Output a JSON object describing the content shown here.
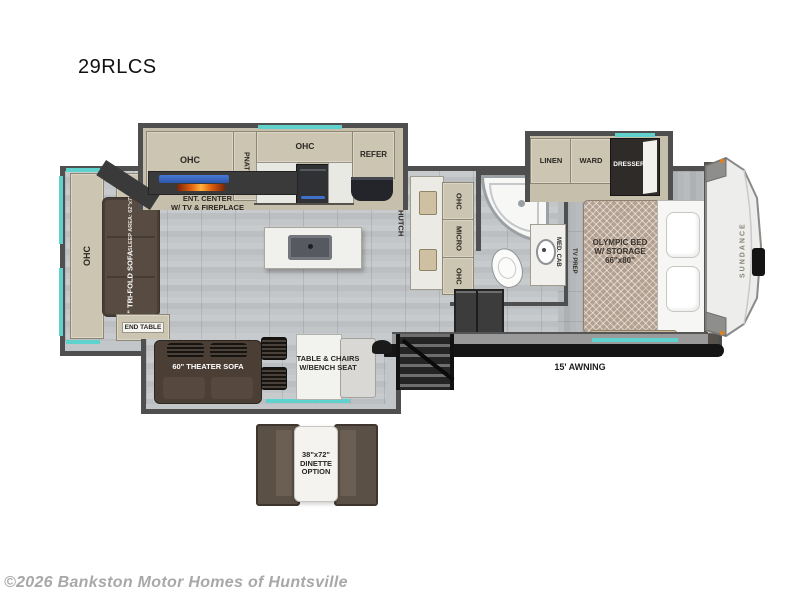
{
  "title": "29RLCS",
  "brand": "SUNDANCE",
  "footer": {
    "copyright": "©2026 Bankston Motor Homes of Huntsville"
  },
  "colors": {
    "accent_teal": "#5fd2ce",
    "wall_gray": "#4f4f4f",
    "cabinet_beige": "#ccc5b1",
    "sofa_brown": "#4a3e35",
    "awning_black": "#151515",
    "fireplace_orange": "#e2620f",
    "tv_blue": "#3f6fc9"
  },
  "living": {
    "ohc_rear": "OHC",
    "end_table_top": "END TABLE",
    "end_table_bottom": "END TABLE",
    "sofa": "75\" TRI-FOLD SOFA",
    "sofa_sleep": "SLEEP AREA: 62\"x73\"",
    "ent_line1": "ENT. CENTER",
    "ent_line2": "W/ TV & FIREPLACE",
    "theater_sofa": "60\" THEATER SOFA",
    "table_line1": "TABLE & CHAIRS",
    "table_line2": "W/BENCH SEAT"
  },
  "kitchen": {
    "ohc_left": "OHC",
    "pantry": "PNATRY",
    "ohc_center": "OHC",
    "refer": "REFER",
    "hutch": "HUTCH",
    "ohc_top": "OHC",
    "micro": "MICRO",
    "ohc_bottom": "OHC"
  },
  "bath": {
    "med_cab": "MED. CAB"
  },
  "bedroom": {
    "linen": "LINEN",
    "ward": "WARD",
    "dresser": "DRESSER",
    "tv_prep": "TV PREP",
    "bed_line1": "OLYMPIC BED",
    "bed_line2": "W/ STORAGE",
    "bed_line3": "66\"x80\""
  },
  "exterior": {
    "awning": "15' AWNING"
  },
  "options": {
    "dinette_line1": "38\"x72\"",
    "dinette_line2": "DINETTE",
    "dinette_line3": "OPTION"
  }
}
